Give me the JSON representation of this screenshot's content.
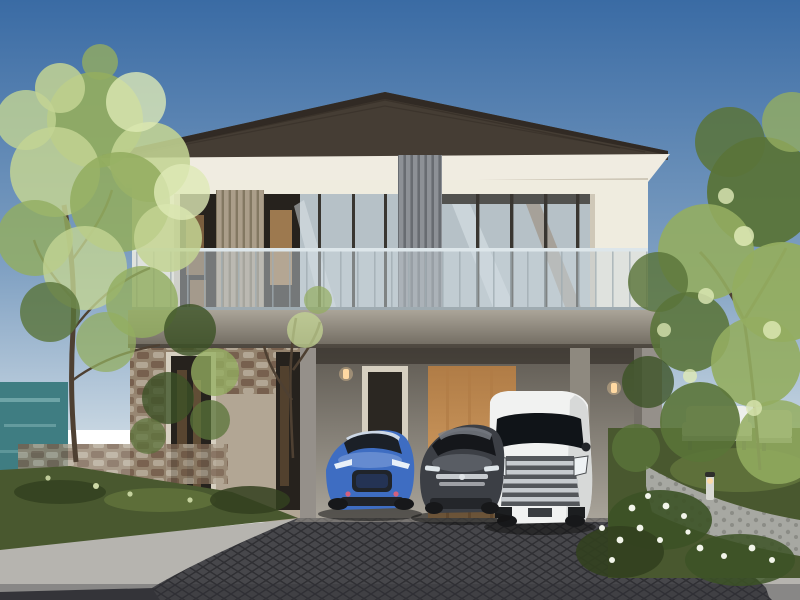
{
  "meta": {
    "title": "Modern two-storey house exterior rendering",
    "type": "photograph",
    "description": "Architectural rendering of a modern two-storey house with a glass-railing balcony, stone-clad ground floor, double carport with three parked cars, trees and landscaped garden under a clear blue sky."
  },
  "colors": {
    "sky_top": "#3a6ba4",
    "sky_mid": "#7fa0c2",
    "sky_low": "#c6d5e1",
    "roof_dark": "#453d34",
    "roof_edge": "#2c2620",
    "fascia": "#f0ece1",
    "fascia_shadow": "#cfc8b8",
    "wall_upper": "#e6e2d6",
    "pillar_white": "#efecdf",
    "window_dark": "#26221d",
    "interior_warm": "#8a6844",
    "interior_warm2": "#bb905c",
    "louver_tan": "#ab9e8a",
    "louver_line": "#837862",
    "slat_gray": "#8d9196",
    "slat_line": "#686c71",
    "glass_blue": "#b6c1c7",
    "glass_reflect": "#dde6ea",
    "mullion": "#393631",
    "railing_glass": "#ccd8de",
    "railing_post": "#9fabb1",
    "slab_top": "#aba599",
    "slab_bottom": "#6e685e",
    "stone_base": "#b2a694",
    "stone_dark": "#77604e",
    "stone_mid": "#93826d",
    "carport_top": "#5f5a52",
    "carport_wall": "#8e897f",
    "carport_floor": "#a9a49a",
    "wood_warm": "#b07c46",
    "wood_light": "#d8a468",
    "door_dark": "#2b2722",
    "door_frame": "#d6cfc0",
    "column_gray": "#95908a",
    "sconce_glow": "#ffd9a2",
    "car_blue": "#3e6dc2",
    "car_blue_light": "#8baade",
    "car_blue_dark": "#27427e",
    "car_gray": "#3c3f45",
    "car_gray_light": "#7d828a",
    "van_white": "#f1f2f1",
    "van_shadow": "#c6c8c8",
    "grille_chrome": "#c7cbcf",
    "grille_dark": "#54575b",
    "tire_dark": "#17181a",
    "shadow_dark": "#121212",
    "drive_paver": "#47474b",
    "paver_line": "#2f2f33",
    "street_dark": "#35353a",
    "curb_light": "#b6b4af",
    "lawn_green": "#49582f",
    "lawn_light": "#6d8142",
    "hedge_dark": "#32401f",
    "leaf_light": "#c3d493",
    "leaf_mid": "#93ad60",
    "leaf_bright": "#dfeab6",
    "leaf_dark": "#5a7439",
    "leaf_deep": "#3c5226",
    "trunk_brown": "#4e4032",
    "water_teal": "#3f7d82",
    "water_light": "#83b5b6",
    "path_stone": "#a7a8a2",
    "path_dot": "#8b8c86",
    "furniture_white": "#edefec",
    "furniture_shadow": "#b8bbb5",
    "flower_white": "#f2f5ea",
    "bollard_body": "#d9d9d3"
  },
  "scene": {
    "objects": [
      {
        "name": "sky",
        "label": "Clear blue sky"
      },
      {
        "name": "left-tree",
        "label": "Tall tree on the left lawn"
      },
      {
        "name": "right-tree",
        "label": "Tree canopy framing the right side"
      },
      {
        "name": "pond",
        "label": "Teal pond behind the left garden"
      },
      {
        "name": "house",
        "label": "Modern two-storey house"
      },
      {
        "name": "roof",
        "label": "Dark hip roof with white fascia"
      },
      {
        "name": "upper-floor",
        "label": "Upper floor with glass walls and louver panels"
      },
      {
        "name": "balcony",
        "label": "Glass-railing balcony"
      },
      {
        "name": "stone-wall",
        "label": "Stone-clad ground-floor wall"
      },
      {
        "name": "carport",
        "label": "Double carport with warm wood interior"
      },
      {
        "name": "entry-door",
        "label": "Entry door inside the carport"
      },
      {
        "name": "blue-coupe",
        "label": "Blue sports coupe"
      },
      {
        "name": "gray-sedan",
        "label": "Dark gray sedan"
      },
      {
        "name": "white-van",
        "label": "White luxury minivan"
      },
      {
        "name": "driveway",
        "label": "Dark paver driveway"
      },
      {
        "name": "left-lawn",
        "label": "Front lawn and hedge on the left"
      },
      {
        "name": "garden-path",
        "label": "Stone garden path on the right"
      },
      {
        "name": "garden-furniture",
        "label": "White outdoor seating set"
      },
      {
        "name": "flowers",
        "label": "White flowering shrubs"
      },
      {
        "name": "bollard-light",
        "label": "Garden bollard light"
      },
      {
        "name": "wall-sconce",
        "label": "Warm wall sconce lights"
      }
    ]
  }
}
